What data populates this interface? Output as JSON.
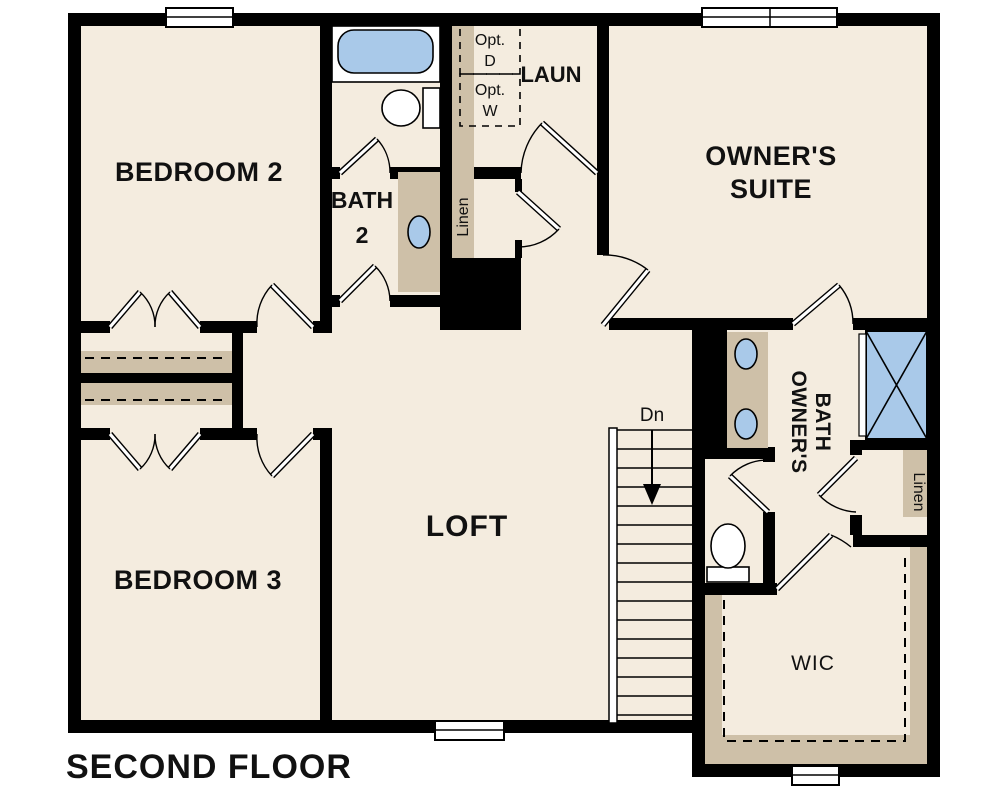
{
  "plan": {
    "title": "SECOND FLOOR",
    "rooms": {
      "bedroom2": {
        "label": "BEDROOM 2"
      },
      "bedroom3": {
        "label": "BEDROOM 3"
      },
      "loft": {
        "label": "LOFT"
      },
      "owners_suite": {
        "line1": "OWNER'S",
        "line2": "SUITE"
      },
      "bath2": {
        "line1": "BATH",
        "line2": "2"
      },
      "laundry": {
        "label": "LAUN"
      },
      "owners_bath": {
        "line1": "OWNER'S",
        "line2": "BATH"
      },
      "wic": {
        "label": "WIC"
      }
    },
    "closets": {
      "linen_left": {
        "label": "Linen"
      },
      "linen_right": {
        "label": "Linen"
      }
    },
    "appliances": {
      "optional_dryer": {
        "line1": "Opt.",
        "line2": "D"
      },
      "optional_washer": {
        "line1": "Opt.",
        "line2": "W"
      }
    },
    "stairs": {
      "direction_label": "Dn"
    },
    "colors": {
      "page_bg": "#ffffff",
      "floor": "#f4ecdf",
      "wall": "#000000",
      "fixture_blue": "#a9c9e9",
      "cabinet_tan": "#cec0a8",
      "appliance_gray": "#e3e3e3"
    }
  }
}
